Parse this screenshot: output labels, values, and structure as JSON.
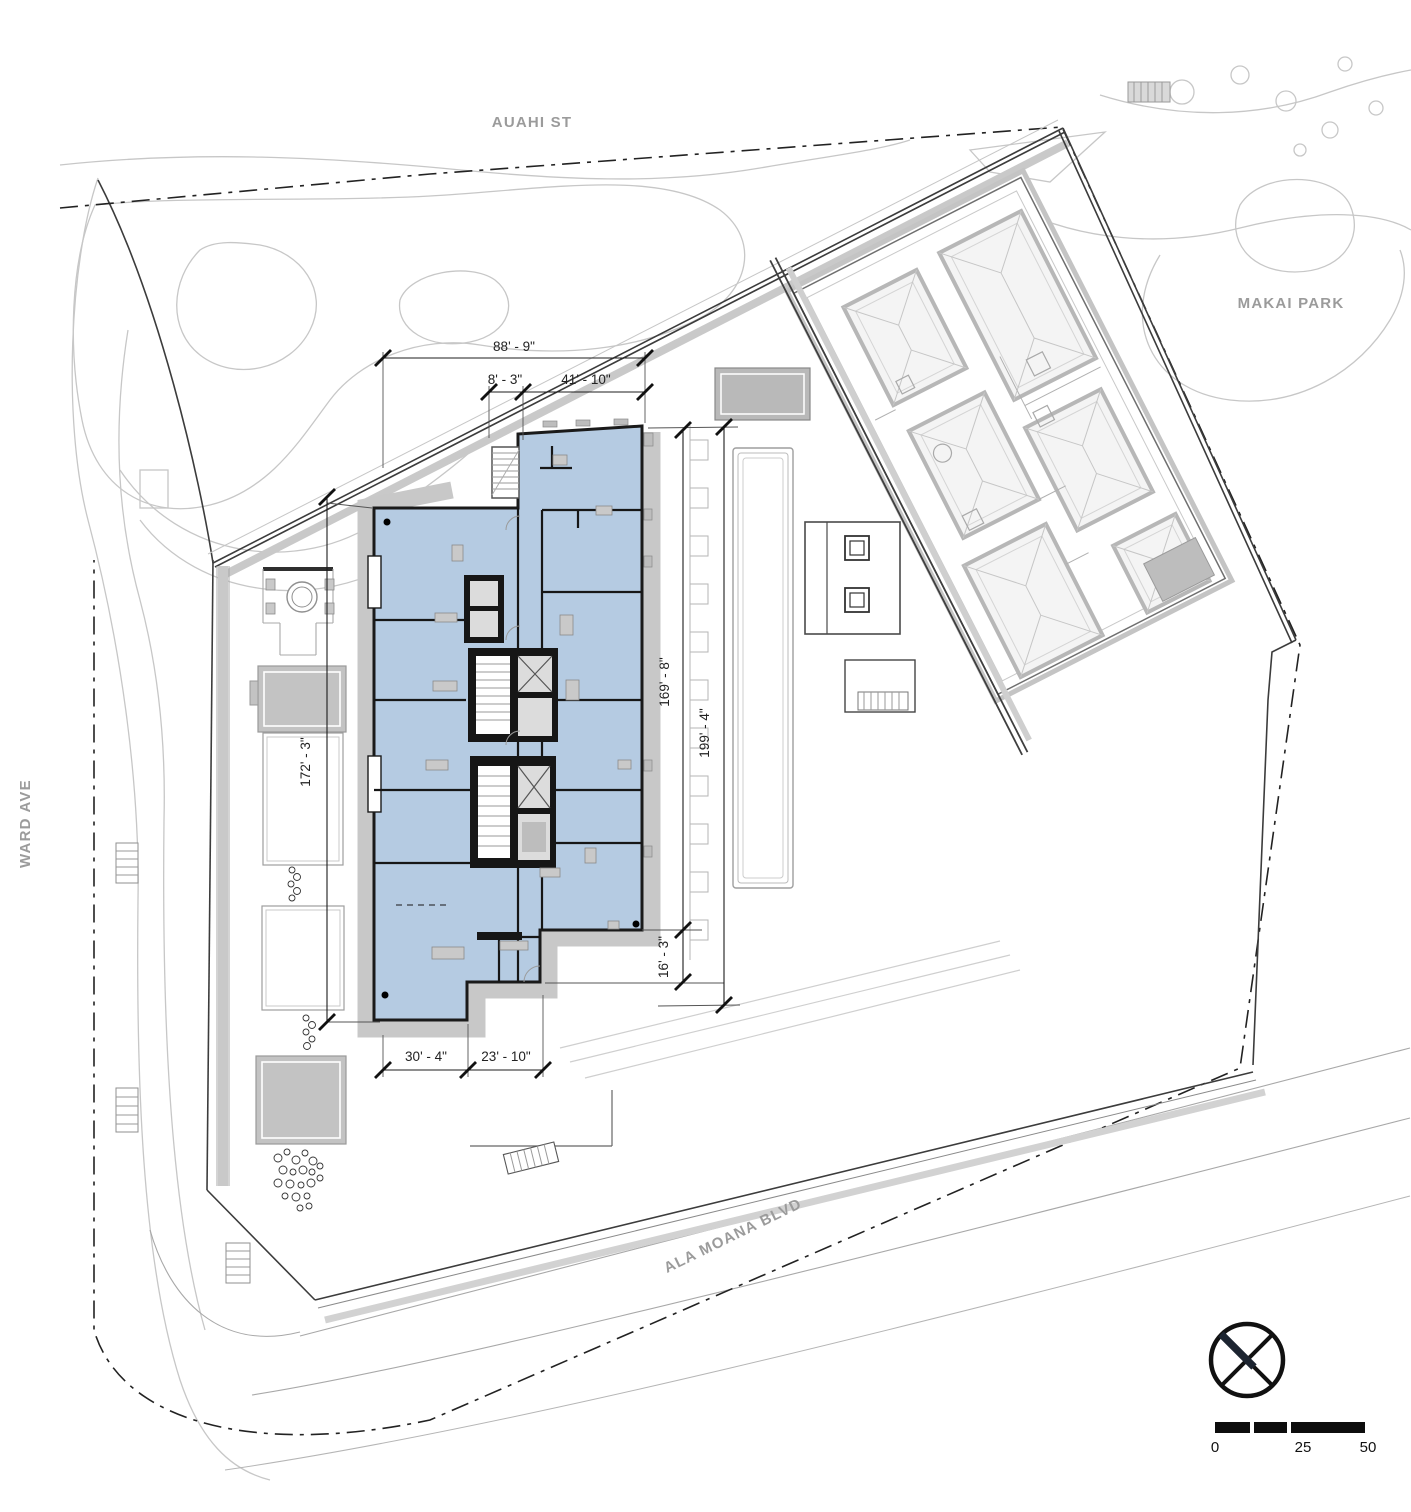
{
  "drawing": {
    "streets": {
      "auahi": "AUAHI ST",
      "ward": "WARD AVE",
      "ala_moana": "ALA MOANA BLVD",
      "makai_park": "MAKAI PARK"
    },
    "dimensions": {
      "overall_top": "88' - 9\"",
      "top_small": "8' - 3\"",
      "top_mid": "41' - 10\"",
      "west_side": "172' - 3\"",
      "east_inner": "169' - 8\"",
      "southeast": "16' - 3\"",
      "east_outer": "199' - 4\"",
      "bottom_left": "30' - 4\"",
      "bottom_right": "23' - 10\""
    },
    "scale_bar": {
      "zero": "0",
      "mid": "25",
      "end": "50"
    },
    "icons": {
      "north_arrow": "north-arrow-icon"
    },
    "colors": {
      "building_fill": "#b5cbe2",
      "wall": "#1a1a1a",
      "podium_gray": "#c8c8c8",
      "label_gray": "#9b9b9b"
    }
  }
}
